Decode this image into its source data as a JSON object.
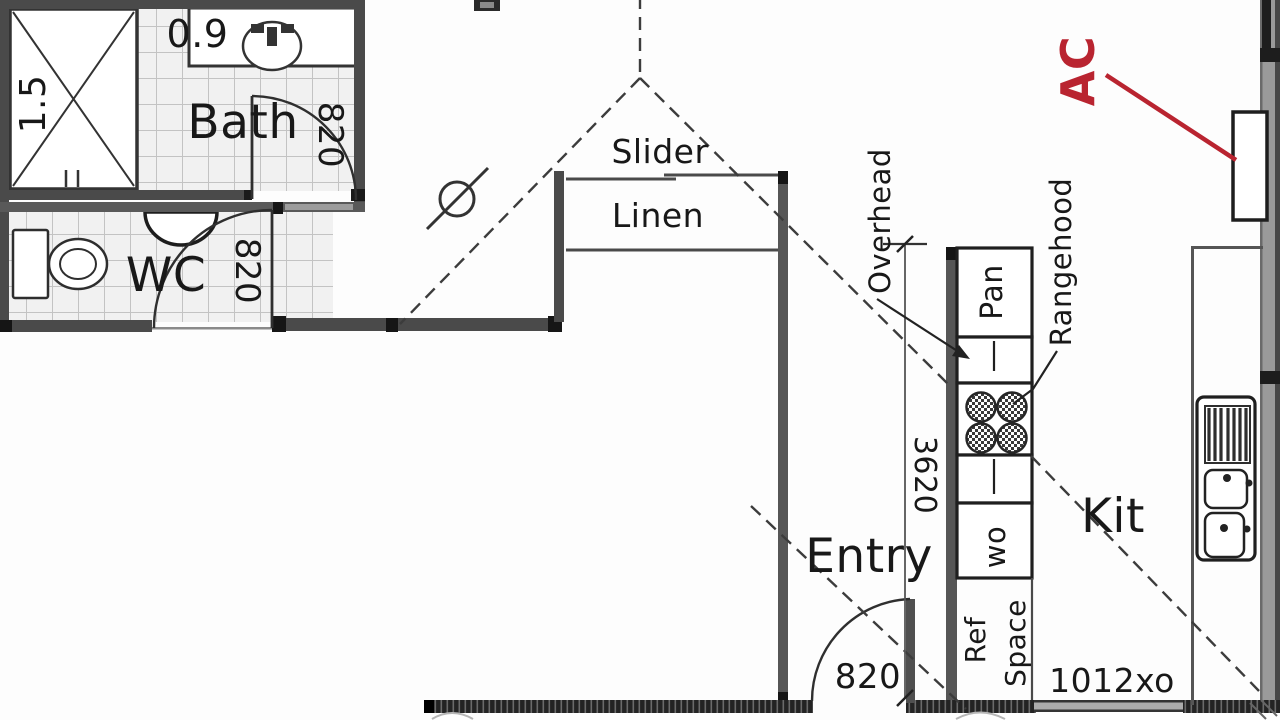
{
  "rooms": {
    "bath": "Bath",
    "wc": "WC",
    "linen": "Linen",
    "entry": "Entry",
    "kitchen": "Kit"
  },
  "labels": {
    "slider": "Slider",
    "overhead": "Overhead",
    "rangehood": "Rangehood",
    "pantry": "Pan",
    "wall_oven": "wo",
    "ref": "Ref",
    "ref_space": "Space",
    "ac": "AC"
  },
  "dims": {
    "shower_width": "0.9",
    "shower_depth": "1.5",
    "bath_door": "820",
    "wc_door": "820",
    "entry_door": "820",
    "kitchen_run": "3620",
    "window_code": "1012xo"
  },
  "colors": {
    "accent": "#b92430",
    "wall": "#4a4a4a",
    "wall_dark": "#161616",
    "line": "#2a2a2a"
  }
}
